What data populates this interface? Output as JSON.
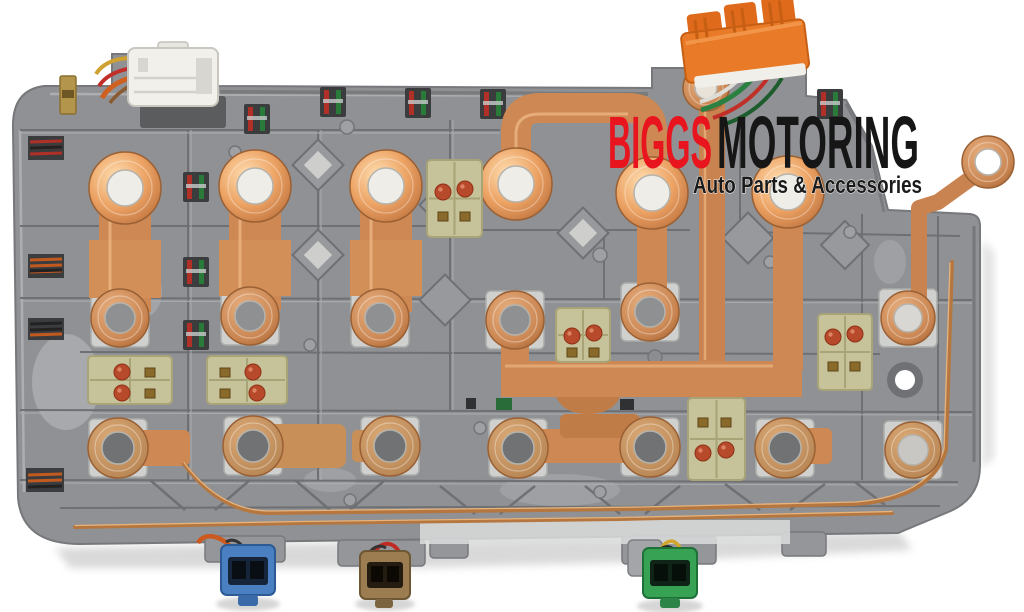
{
  "image_type": "product-photo",
  "subject": "Automatic transmission solenoid circuit board with copper bus bars",
  "background_color": "#ffffff",
  "watermark": {
    "brand_first": "BIGGS",
    "brand_second": "MOTORING",
    "brand_first_color": "#e8141e",
    "brand_second_color": "#161616",
    "tagline": "Auto Parts & Accessories",
    "tagline_color": "#1a1a1a",
    "tagline_outline_color": "#ffffff"
  },
  "board": {
    "body_color": "#8f9194",
    "rib_light": "#a6a8ab",
    "rib_dark": "#6d6f72",
    "recess_color": "#7b7d80",
    "seat_color": "#d6d7d5"
  },
  "copper": {
    "bright": "#eca768",
    "mid": "#cd8853",
    "tan": "#c89058",
    "dark": "#a06434",
    "wire": "#b5773f",
    "highlight": "#f6d3a6"
  },
  "connectors": {
    "top_left_white": {
      "label": "white multi-pin connector",
      "color": "#f2f0ea",
      "wire_colors": [
        "#d06020",
        "#c03028",
        "#d0a030",
        "#8a5a30"
      ]
    },
    "top_right_orange": {
      "label": "orange multi-pin connector",
      "color": "#e87a28",
      "wire_colors": [
        "#2a8040",
        "#c03028",
        "#1d5c2c"
      ]
    },
    "bottom_blue": {
      "label": "blue 2-pin connector",
      "color": "#4a80c2",
      "wire_color": "#cc5a1e"
    },
    "bottom_brown": {
      "label": "brown 2-pin connector",
      "color": "#9b7d51",
      "wire_color": "#c02a22"
    },
    "bottom_green": {
      "label": "green 2-pin connector",
      "color": "#37a254",
      "wire_color": "#d2a62e"
    }
  },
  "components": {
    "bright_ring_terminals": 6,
    "gray_center_ring_terminals": 12,
    "external_ring_terminals": 2,
    "diode_blocks": 6,
    "diode_block_color": "#c6c299",
    "diode_dot_color": "#b84a2c",
    "wire_pair_colors": [
      "#b03028",
      "#2a7a3a"
    ]
  }
}
